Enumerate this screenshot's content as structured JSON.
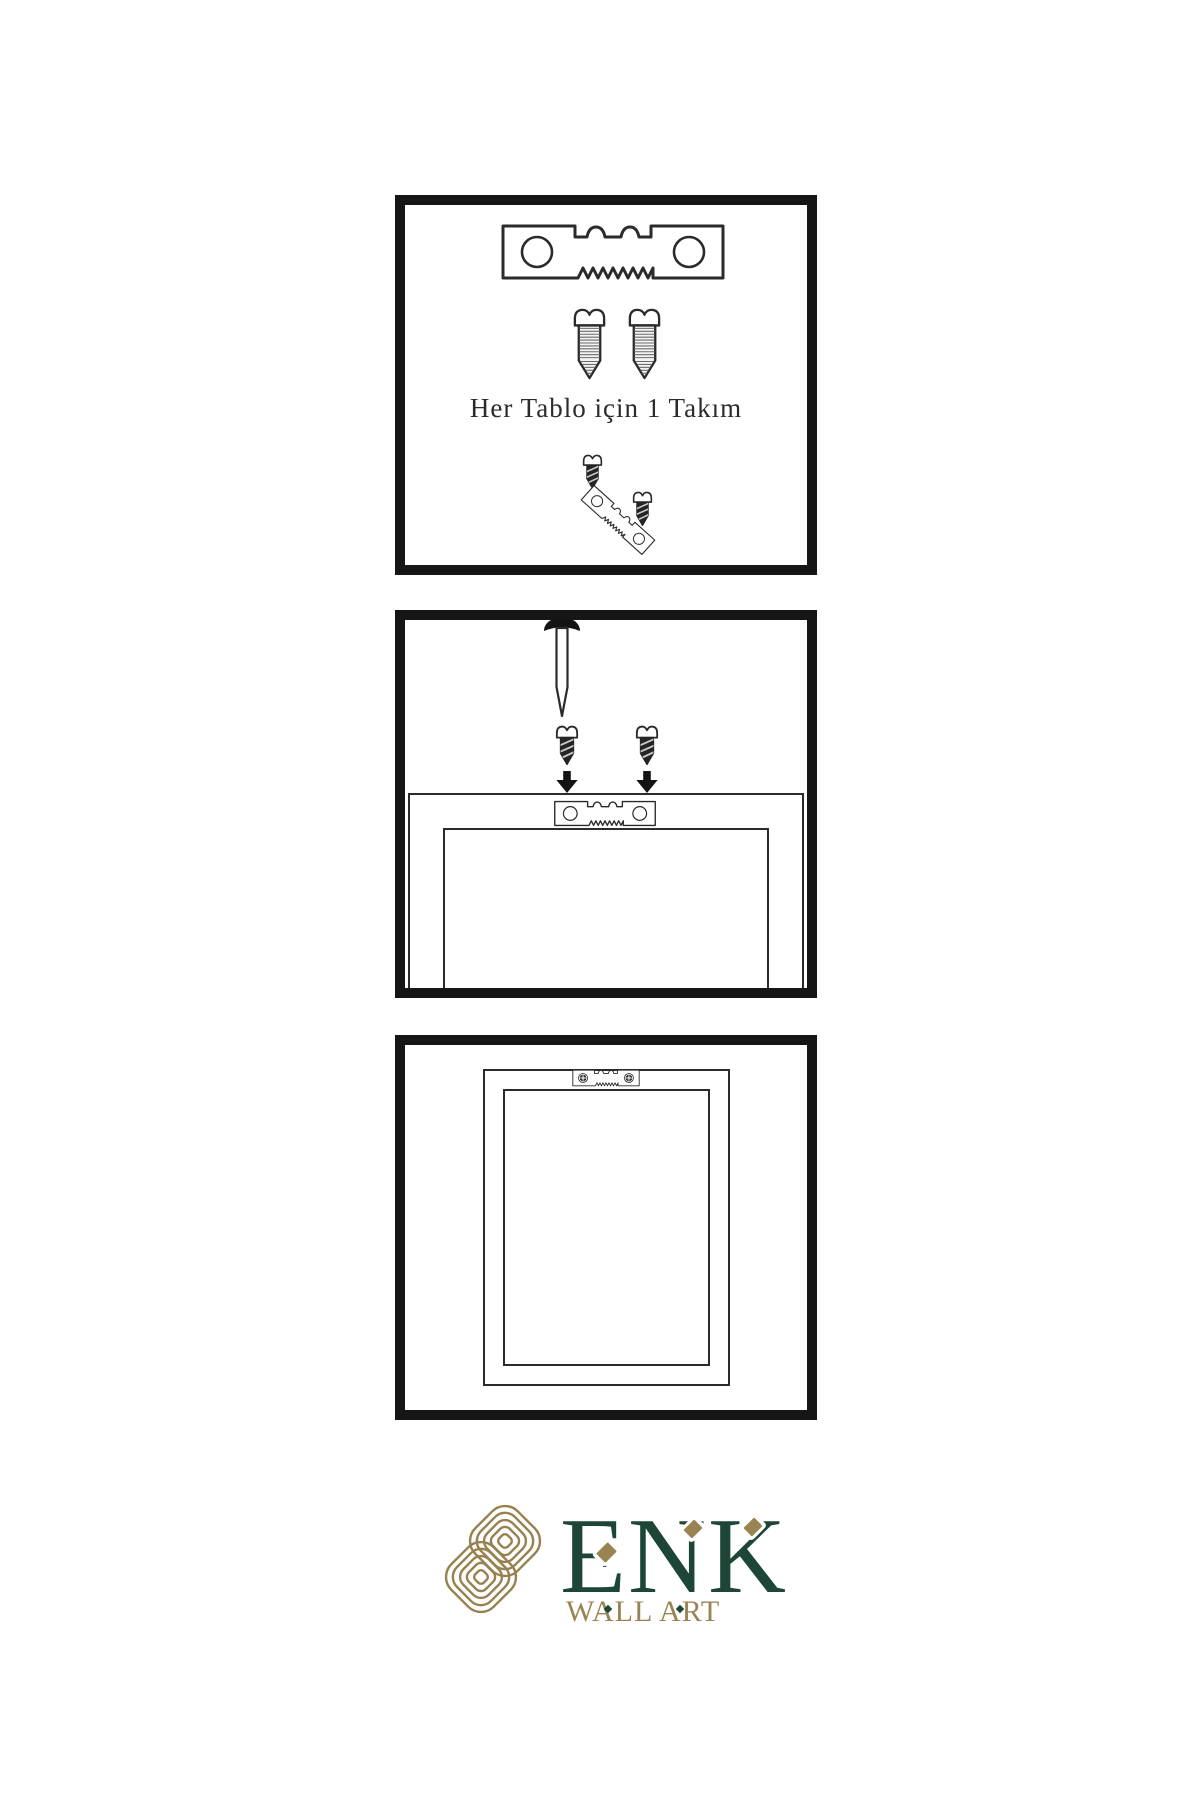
{
  "sheet": {
    "background": "#ffffff",
    "description": "wall-art hanging hardware instruction sheet"
  },
  "colors": {
    "panel_border": "#161616",
    "line_art": "#2b2b2b",
    "brand_green": "#1d4636",
    "brand_gold": "#9a8352"
  },
  "panels": [
    {
      "name": "hardware-kit",
      "caption": "Her Tablo için 1 Takım",
      "icons": [
        "sawtooth-hanger-icon",
        "screw-icon",
        "screw-icon",
        "small-screw-icon",
        "tilted-sawtooth-hanger-icon",
        "small-screw-icon"
      ]
    },
    {
      "name": "mount-hanger-on-frame-back",
      "icons": [
        "nail-icon",
        "screw-icon",
        "down-arrow-icon",
        "screw-icon",
        "down-arrow-icon",
        "frame-back-icon",
        "sawtooth-hanger-icon"
      ]
    },
    {
      "name": "frame-hung-on-wall",
      "icons": [
        "frame-front-icon",
        "sawtooth-hanger-screwed-icon"
      ]
    }
  ],
  "logo": {
    "emblem": "knot-emblem-icon",
    "brand": "ENK",
    "subtitle": "WALL ART",
    "accents": [
      "diamond-accent",
      "diamond-accent",
      "diamond-accent"
    ]
  }
}
